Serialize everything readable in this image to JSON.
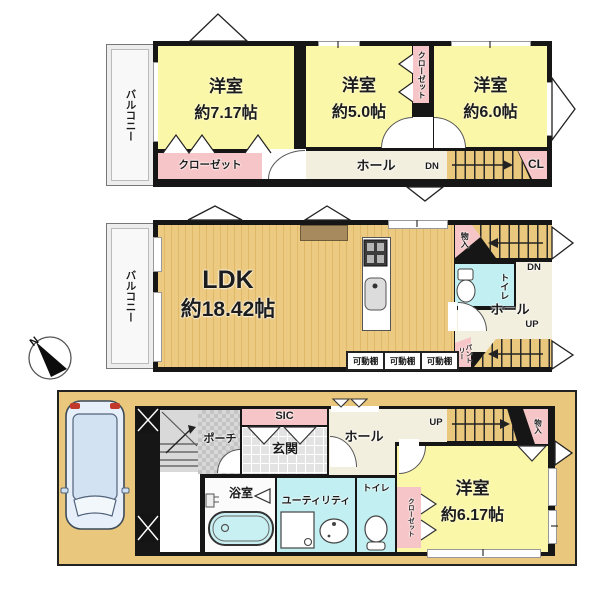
{
  "compass": {
    "north": "N"
  },
  "colors": {
    "room_yellow": "#fbf7a9",
    "closet_pink": "#f6c5c7",
    "wet_area_cyan": "#c2eff1",
    "hall_cream": "#f3efdf",
    "stairs_tan": "#e9c77c",
    "wall_black": "#161616",
    "lot_tan": "#e9c77c"
  },
  "floor3": {
    "balcony": "バルコニー",
    "rooms": [
      {
        "name": "洋室",
        "size": "約7.17帖"
      },
      {
        "name": "洋室",
        "size": "約5.0帖"
      },
      {
        "name": "洋室",
        "size": "約6.0帖"
      }
    ],
    "closet_a": "クローゼット",
    "closet_b": "クローゼット",
    "hall": "ホール",
    "dn": "DN",
    "cl": "CL"
  },
  "floor2": {
    "balcony": "バルコニー",
    "ldk": {
      "name": "LDK",
      "size": "約18.42帖"
    },
    "storage": "物入",
    "toilet": "トイレ",
    "hall": "ホール",
    "dn": "DN",
    "up": "UP",
    "pantry": "パントリー",
    "shelves": [
      "可動棚",
      "可動棚",
      "可動棚"
    ]
  },
  "floor1": {
    "sic": "SIC",
    "porch": "ポーチ",
    "entrance": "玄関",
    "hall": "ホール",
    "up": "UP",
    "storage": "物入",
    "room": {
      "name": "洋室",
      "size": "約6.17帖"
    },
    "toilet": "トイレ",
    "closet": "クローゼット",
    "utility": "ユーティリティ",
    "bath": "浴室"
  }
}
